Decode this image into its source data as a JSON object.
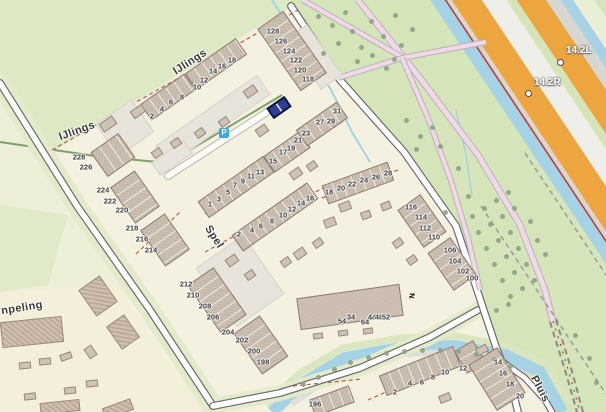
{
  "map": {
    "colors": {
      "cream": "#f1eedb",
      "neighborhood": "#f4f1e0",
      "meadow": "#dde9c5",
      "green_right": "#d6e4ba",
      "pale_green": "#e9eed6",
      "water": "#a5d2e4",
      "highway_orange": "#eda63f",
      "highway_grey": "#d8d6d1",
      "highway_light": "#efeee9",
      "road_fill": "#ffffff",
      "road_casing": "#6f6f6f",
      "pink_road": "#f2d7e8",
      "boundary_red": "#b06050",
      "canal_red_line": "#b5423a",
      "tree": "#8ba287",
      "selected": "#2b3f96",
      "parking": "#3fa8df",
      "building": "#c6b8a9"
    },
    "street_labels": [
      {
        "text": "IJlings",
        "x": 190,
        "y": 62,
        "r": -33
      },
      {
        "text": "IJlings",
        "x": 77,
        "y": 131,
        "r": -20
      },
      {
        "text": "Spel",
        "x": 214,
        "y": 237,
        "r": 57
      },
      {
        "text": "npeling",
        "x": 22,
        "y": 308,
        "r": -9
      },
      {
        "text": "Pluis",
        "x": 540,
        "y": 389,
        "r": 62
      }
    ],
    "hm_markers": [
      {
        "label": "14.2L",
        "cx": 559,
        "cy": 61,
        "tx": 566,
        "ty": 52
      },
      {
        "label": "14.2R",
        "cx": 527,
        "cy": 92,
        "tx": 534,
        "ty": 84
      }
    ],
    "icons": {
      "parking": {
        "glyph": "P",
        "x": 224,
        "y": 133
      },
      "dam": {
        "glyph": "≠",
        "x": 413,
        "y": 297
      }
    },
    "house_numbers": [
      {
        "t": "2",
        "x": 152,
        "y": 116
      },
      {
        "t": "4",
        "x": 162,
        "y": 109
      },
      {
        "t": "6",
        "x": 171,
        "y": 102
      },
      {
        "t": "8",
        "x": 182,
        "y": 97
      },
      {
        "t": "10",
        "x": 197,
        "y": 87
      },
      {
        "t": "12",
        "x": 204,
        "y": 80
      },
      {
        "t": "14",
        "x": 213,
        "y": 71
      },
      {
        "t": "16",
        "x": 222,
        "y": 66
      },
      {
        "t": "18",
        "x": 232,
        "y": 60
      },
      {
        "t": "128",
        "x": 273,
        "y": 31
      },
      {
        "t": "126",
        "x": 281,
        "y": 41
      },
      {
        "t": "124",
        "x": 289,
        "y": 51
      },
      {
        "t": "122",
        "x": 296,
        "y": 60
      },
      {
        "t": "120",
        "x": 300,
        "y": 70
      },
      {
        "t": "118",
        "x": 308,
        "y": 79
      },
      {
        "t": "1",
        "x": 210,
        "y": 204
      },
      {
        "t": "3",
        "x": 219,
        "y": 199
      },
      {
        "t": "5",
        "x": 228,
        "y": 192
      },
      {
        "t": "7",
        "x": 235,
        "y": 185
      },
      {
        "t": "9",
        "x": 243,
        "y": 181
      },
      {
        "t": "11",
        "x": 251,
        "y": 176
      },
      {
        "t": "13",
        "x": 260,
        "y": 172
      },
      {
        "t": "15",
        "x": 273,
        "y": 161
      },
      {
        "t": "17",
        "x": 283,
        "y": 152
      },
      {
        "t": "19",
        "x": 291,
        "y": 148
      },
      {
        "t": "21",
        "x": 298,
        "y": 140
      },
      {
        "t": "23",
        "x": 306,
        "y": 133
      },
      {
        "t": "27",
        "x": 320,
        "y": 122
      },
      {
        "t": "29",
        "x": 331,
        "y": 121
      },
      {
        "t": "31",
        "x": 337,
        "y": 111
      },
      {
        "t": "2",
        "x": 239,
        "y": 234
      },
      {
        "t": "4",
        "x": 252,
        "y": 230
      },
      {
        "t": "6",
        "x": 261,
        "y": 226
      },
      {
        "t": "8",
        "x": 272,
        "y": 221
      },
      {
        "t": "10",
        "x": 283,
        "y": 215
      },
      {
        "t": "12",
        "x": 292,
        "y": 209
      },
      {
        "t": "14",
        "x": 301,
        "y": 203
      },
      {
        "t": "16",
        "x": 310,
        "y": 198
      },
      {
        "t": "18",
        "x": 329,
        "y": 192
      },
      {
        "t": "20",
        "x": 341,
        "y": 188
      },
      {
        "t": "22",
        "x": 352,
        "y": 184
      },
      {
        "t": "24",
        "x": 364,
        "y": 180
      },
      {
        "t": "26",
        "x": 376,
        "y": 177
      },
      {
        "t": "28",
        "x": 388,
        "y": 173
      },
      {
        "t": "116",
        "x": 411,
        "y": 207
      },
      {
        "t": "114",
        "x": 421,
        "y": 217
      },
      {
        "t": "112",
        "x": 425,
        "y": 228
      },
      {
        "t": "110",
        "x": 434,
        "y": 237
      },
      {
        "t": "106",
        "x": 450,
        "y": 250
      },
      {
        "t": "104",
        "x": 455,
        "y": 261
      },
      {
        "t": "102",
        "x": 463,
        "y": 271
      },
      {
        "t": "100",
        "x": 472,
        "y": 278
      },
      {
        "t": "228",
        "x": 79,
        "y": 157
      },
      {
        "t": "226",
        "x": 86,
        "y": 167
      },
      {
        "t": "224",
        "x": 103,
        "y": 190
      },
      {
        "t": "222",
        "x": 110,
        "y": 201
      },
      {
        "t": "220",
        "x": 122,
        "y": 210
      },
      {
        "t": "218",
        "x": 132,
        "y": 228
      },
      {
        "t": "216",
        "x": 142,
        "y": 239
      },
      {
        "t": "214",
        "x": 151,
        "y": 250
      },
      {
        "t": "212",
        "x": 186,
        "y": 284
      },
      {
        "t": "210",
        "x": 193,
        "y": 295
      },
      {
        "t": "208",
        "x": 205,
        "y": 306
      },
      {
        "t": "206",
        "x": 213,
        "y": 317
      },
      {
        "t": "204",
        "x": 228,
        "y": 332
      },
      {
        "t": "202",
        "x": 242,
        "y": 340
      },
      {
        "t": "200",
        "x": 254,
        "y": 351
      },
      {
        "t": "198",
        "x": 263,
        "y": 362
      },
      {
        "t": "196",
        "x": 315,
        "y": 404
      },
      {
        "t": "54",
        "x": 342,
        "y": 321
      },
      {
        "t": "34",
        "x": 351,
        "y": 317
      },
      {
        "t": "64",
        "x": 365,
        "y": 322
      },
      {
        "t": "44",
        "x": 372,
        "y": 317
      },
      {
        "t": "48",
        "x": 379,
        "y": 317
      },
      {
        "t": "52",
        "x": 386,
        "y": 317
      },
      {
        "t": "2",
        "x": 395,
        "y": 392
      },
      {
        "t": "4",
        "x": 410,
        "y": 383
      },
      {
        "t": "6",
        "x": 422,
        "y": 382
      },
      {
        "t": "8",
        "x": 433,
        "y": 377
      },
      {
        "t": "10",
        "x": 445,
        "y": 372
      },
      {
        "t": "12",
        "x": 463,
        "y": 368
      },
      {
        "t": "14",
        "x": 498,
        "y": 362
      },
      {
        "t": "16",
        "x": 503,
        "y": 373
      },
      {
        "t": "18",
        "x": 510,
        "y": 384
      },
      {
        "t": "20",
        "x": 520,
        "y": 396
      }
    ],
    "buildings": [
      {
        "x": 125,
        "y": 128,
        "w": 44,
        "h": 40,
        "r": -35,
        "t": "pad"
      },
      {
        "x": 213,
        "y": 120,
        "w": 124,
        "h": 24,
        "r": -35,
        "t": "pad"
      },
      {
        "x": 240,
        "y": 281,
        "w": 58,
        "h": 72,
        "r": -35,
        "t": "pad"
      },
      {
        "x": 314,
        "y": 57,
        "w": 26,
        "h": 62,
        "r": -35,
        "t": "pad"
      },
      {
        "x": 172,
        "y": 158,
        "w": 40,
        "h": 16,
        "r": -35,
        "t": "pad"
      },
      {
        "x": 168,
        "y": 97,
        "w": 54,
        "h": 20,
        "r": -35,
        "t": "row"
      },
      {
        "x": 216,
        "y": 64,
        "w": 62,
        "h": 20,
        "r": -35,
        "t": "row"
      },
      {
        "x": 292,
        "y": 51,
        "w": 32,
        "h": 76,
        "r": -35,
        "t": "row"
      },
      {
        "x": 236,
        "y": 187,
        "w": 80,
        "h": 20,
        "r": -35,
        "t": "row"
      },
      {
        "x": 287,
        "y": 152,
        "w": 44,
        "h": 20,
        "r": -35,
        "t": "row"
      },
      {
        "x": 322,
        "y": 124,
        "w": 50,
        "h": 20,
        "r": -35,
        "t": "row"
      },
      {
        "x": 275,
        "y": 217,
        "w": 92,
        "h": 20,
        "r": -35,
        "t": "row"
      },
      {
        "x": 358,
        "y": 183,
        "w": 70,
        "h": 20,
        "r": -20,
        "t": "row"
      },
      {
        "x": 422,
        "y": 221,
        "w": 28,
        "h": 46,
        "r": -35,
        "t": "row"
      },
      {
        "x": 452,
        "y": 264,
        "w": 28,
        "h": 46,
        "r": -35,
        "t": "row"
      },
      {
        "x": 113,
        "y": 155,
        "w": 34,
        "h": 30,
        "r": -35,
        "t": "row"
      },
      {
        "x": 135,
        "y": 197,
        "w": 30,
        "h": 44,
        "r": -35,
        "t": "row"
      },
      {
        "x": 165,
        "y": 240,
        "w": 30,
        "h": 44,
        "r": -35,
        "t": "row"
      },
      {
        "x": 217,
        "y": 300,
        "w": 32,
        "h": 58,
        "r": -35,
        "t": "row"
      },
      {
        "x": 261,
        "y": 345,
        "w": 32,
        "h": 50,
        "r": -35,
        "t": "row"
      },
      {
        "x": 350,
        "y": 307,
        "w": 104,
        "h": 32,
        "r": -8,
        "t": "flat"
      },
      {
        "x": 420,
        "y": 371,
        "w": 80,
        "h": 22,
        "r": -22,
        "t": "row"
      },
      {
        "x": 470,
        "y": 357,
        "w": 22,
        "h": 26,
        "r": -30,
        "t": "row"
      },
      {
        "x": 497,
        "y": 379,
        "w": 34,
        "h": 54,
        "r": -32,
        "t": "row"
      },
      {
        "x": 332,
        "y": 401,
        "w": 42,
        "h": 18,
        "r": -20,
        "t": "row"
      },
      {
        "x": 108,
        "y": 124,
        "w": 16,
        "h": 10,
        "r": -35,
        "t": "shed"
      },
      {
        "x": 138,
        "y": 111,
        "w": 14,
        "h": 9,
        "r": -35,
        "t": "shed"
      },
      {
        "x": 250,
        "y": 91,
        "w": 13,
        "h": 9,
        "r": -35,
        "t": "shed"
      },
      {
        "x": 262,
        "y": 130,
        "w": 12,
        "h": 9,
        "r": -35,
        "t": "shed"
      },
      {
        "x": 200,
        "y": 133,
        "w": 10,
        "h": 8,
        "r": -35,
        "t": "shed"
      },
      {
        "x": 224,
        "y": 122,
        "w": 10,
        "h": 8,
        "r": -35,
        "t": "shed"
      },
      {
        "x": 176,
        "y": 143,
        "w": 10,
        "h": 8,
        "r": -35,
        "t": "shed"
      },
      {
        "x": 157,
        "y": 153,
        "w": 10,
        "h": 8,
        "r": -35,
        "t": "shed"
      },
      {
        "x": 296,
        "y": 173,
        "w": 12,
        "h": 9,
        "r": -35,
        "t": "shed"
      },
      {
        "x": 312,
        "y": 166,
        "w": 10,
        "h": 8,
        "r": -35,
        "t": "shed"
      },
      {
        "x": 345,
        "y": 206,
        "w": 12,
        "h": 9,
        "r": -20,
        "t": "shed"
      },
      {
        "x": 330,
        "y": 222,
        "w": 12,
        "h": 9,
        "r": -20,
        "t": "shed"
      },
      {
        "x": 366,
        "y": 215,
        "w": 10,
        "h": 8,
        "r": -20,
        "t": "shed"
      },
      {
        "x": 386,
        "y": 206,
        "w": 10,
        "h": 8,
        "r": -20,
        "t": "shed"
      },
      {
        "x": 300,
        "y": 253,
        "w": 12,
        "h": 9,
        "r": -35,
        "t": "shed"
      },
      {
        "x": 286,
        "y": 262,
        "w": 10,
        "h": 8,
        "r": -35,
        "t": "shed"
      },
      {
        "x": 318,
        "y": 243,
        "w": 10,
        "h": 8,
        "r": -35,
        "t": "shed"
      },
      {
        "x": 232,
        "y": 260,
        "w": 12,
        "h": 9,
        "r": -35,
        "t": "shed"
      },
      {
        "x": 250,
        "y": 275,
        "w": 10,
        "h": 8,
        "r": -35,
        "t": "shed"
      },
      {
        "x": 398,
        "y": 243,
        "w": 10,
        "h": 8,
        "r": -35,
        "t": "shed"
      },
      {
        "x": 412,
        "y": 260,
        "w": 10,
        "h": 8,
        "r": -35,
        "t": "shed"
      },
      {
        "x": 318,
        "y": 336,
        "w": 10,
        "h": 6,
        "r": -8,
        "t": "shed"
      },
      {
        "x": 343,
        "y": 333,
        "w": 10,
        "h": 6,
        "r": -8,
        "t": "shed"
      },
      {
        "x": 368,
        "y": 331,
        "w": 10,
        "h": 6,
        "r": -8,
        "t": "shed"
      },
      {
        "x": 482,
        "y": 350,
        "w": 12,
        "h": 8,
        "r": -30,
        "t": "shed"
      },
      {
        "x": 445,
        "y": 398,
        "w": 12,
        "h": 8,
        "r": -22,
        "t": "shed"
      },
      {
        "x": 32,
        "y": 332,
        "w": 62,
        "h": 26,
        "r": -6,
        "t": "hatch"
      },
      {
        "x": 98,
        "y": 296,
        "w": 26,
        "h": 32,
        "r": -35,
        "t": "hatch"
      },
      {
        "x": 123,
        "y": 332,
        "w": 22,
        "h": 28,
        "r": -35,
        "t": "hatch"
      },
      {
        "x": 60,
        "y": 407,
        "w": 40,
        "h": 12,
        "r": -6,
        "t": "hatch"
      },
      {
        "x": 118,
        "y": 409,
        "w": 30,
        "h": 12,
        "r": -20,
        "t": "hatch"
      },
      {
        "x": 25,
        "y": 365,
        "w": 12,
        "h": 7,
        "r": -6,
        "t": "shed"
      },
      {
        "x": 45,
        "y": 361,
        "w": 12,
        "h": 7,
        "r": -6,
        "t": "shed"
      },
      {
        "x": 66,
        "y": 356,
        "w": 12,
        "h": 7,
        "r": -20,
        "t": "shed"
      },
      {
        "x": 70,
        "y": 390,
        "w": 12,
        "h": 7,
        "r": -6,
        "t": "shed"
      },
      {
        "x": 92,
        "y": 383,
        "w": 12,
        "h": 7,
        "r": -6,
        "t": "shed"
      },
      {
        "x": 30,
        "y": 396,
        "w": 12,
        "h": 7,
        "r": -6,
        "t": "shed"
      },
      {
        "x": 90,
        "y": 352,
        "w": 9,
        "h": 12,
        "r": -35,
        "t": "shed"
      },
      {
        "x": 279,
        "y": 107,
        "w": 22,
        "h": 13,
        "r": -35,
        "t": "selected"
      }
    ],
    "trees": [
      [
        318,
        16
      ],
      [
        332,
        25
      ],
      [
        345,
        12
      ],
      [
        352,
        31
      ],
      [
        338,
        43
      ],
      [
        323,
        53
      ],
      [
        361,
        47
      ],
      [
        371,
        21
      ],
      [
        383,
        36
      ],
      [
        395,
        15
      ],
      [
        401,
        45
      ],
      [
        412,
        29
      ],
      [
        357,
        61
      ],
      [
        394,
        59
      ],
      [
        372,
        55
      ],
      [
        386,
        68
      ],
      [
        406,
        120
      ],
      [
        420,
        136
      ],
      [
        432,
        127
      ],
      [
        416,
        149
      ],
      [
        440,
        146
      ],
      [
        458,
        168
      ],
      [
        468,
        196
      ],
      [
        445,
        212
      ],
      [
        472,
        216
      ],
      [
        484,
        208
      ],
      [
        496,
        200
      ],
      [
        508,
        192
      ],
      [
        478,
        232
      ],
      [
        490,
        224
      ],
      [
        502,
        216
      ],
      [
        514,
        208
      ],
      [
        486,
        248
      ],
      [
        498,
        240
      ],
      [
        510,
        232
      ],
      [
        530,
        221
      ],
      [
        494,
        264
      ],
      [
        506,
        256
      ],
      [
        518,
        248
      ],
      [
        537,
        240
      ],
      [
        502,
        280
      ],
      [
        514,
        272
      ],
      [
        526,
        264
      ],
      [
        545,
        254
      ],
      [
        510,
        296
      ],
      [
        522,
        288
      ],
      [
        534,
        280
      ],
      [
        496,
        310
      ],
      [
        508,
        304
      ],
      [
        303,
        384
      ],
      [
        318,
        377
      ],
      [
        334,
        369
      ],
      [
        350,
        362
      ],
      [
        368,
        357
      ],
      [
        386,
        353
      ],
      [
        404,
        351
      ],
      [
        422,
        350
      ],
      [
        440,
        350
      ],
      [
        458,
        351
      ],
      [
        476,
        354
      ],
      [
        494,
        359
      ],
      [
        510,
        366
      ],
      [
        575,
        335
      ],
      [
        589,
        358
      ],
      [
        596,
        382
      ]
    ]
  }
}
